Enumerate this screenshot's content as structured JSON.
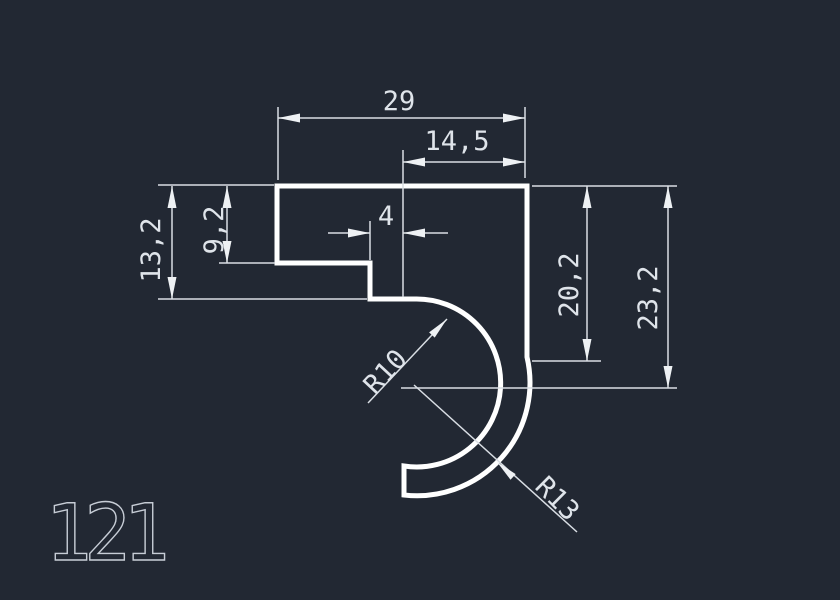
{
  "drawing": {
    "part_number": "121",
    "dimensions": {
      "overall_width": "29",
      "top_right_width": "14,5",
      "left_height": "13,2",
      "left_inner_height": "9,2",
      "step_width": "4",
      "right_inner_height": "20,2",
      "right_overall_height": "23,2",
      "inner_radius": "R10",
      "outer_radius": "R13"
    },
    "colors": {
      "background": "#222833",
      "geometry_line": "#ffffff",
      "dimension_line": "#d9dee4",
      "dimension_text": "#dfe4ea",
      "part_label": "#c7cdd6"
    }
  }
}
